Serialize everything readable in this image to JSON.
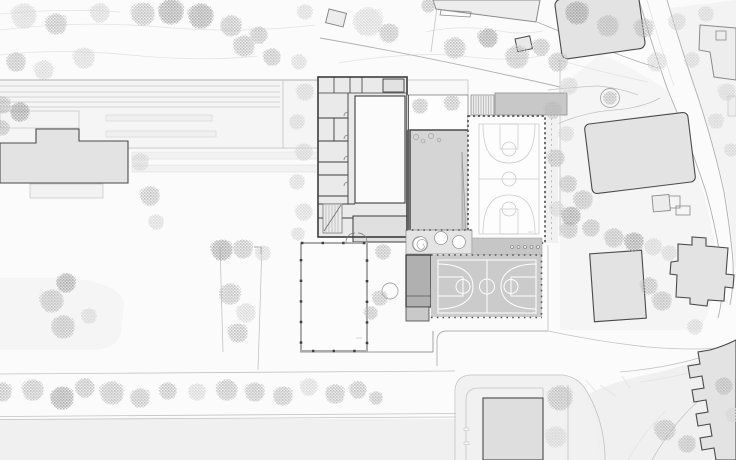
{
  "document": {
    "type": "architectural-site-plan",
    "visible_text": [],
    "note": "black-and-white site plan of a school complex; the only text in the drawing is a few sub-pixel illegible elevation/room labels"
  },
  "palette": {
    "bg": "#fbfbfb",
    "parcel": "#f5f5f5",
    "parcel2": "#f0f0f0",
    "track": "#c6c6c6",
    "contour": "#e3e3e3",
    "roadline": "#c3c3c3",
    "roadline2": "#b0b0b0",
    "bld_fill": "#e3e3e3",
    "bld_fill_light": "#ededed",
    "bld_stroke": "#8a8a8a",
    "bld_stroke_dark": "#4a4a4a",
    "floor": "#eaeaea",
    "wall": "#3c3c3c",
    "wall_mid": "#777777",
    "room_white": "#fbfbfb",
    "gym": "#d5d5d5",
    "roof": "#c8c8c8",
    "dark_annex": "#b0b0b0",
    "court_out": "#cbcbcb",
    "court_out_sub": "#c6c6c6",
    "court_line_in": "#c9c9c9",
    "fence": "#555555",
    "tree_l": "#d2d2d2",
    "tree_m": "#b7b7b7",
    "tree_d": "#9d9d9d",
    "white": "#ffffff"
  },
  "features": [
    {
      "name": "school-main-building",
      "kind": "detailed floor plan with classrooms, corridor, stair"
    },
    {
      "name": "gymnasium",
      "kind": "grey hall with ramp and equipment circles"
    },
    {
      "name": "indoor-basketball-court",
      "kind": "vertical court inside glazed hall, dashed facade"
    },
    {
      "name": "outdoor-basketball-court",
      "kind": "horizontal grey court with white markings and fence posts"
    },
    {
      "name": "pavilion-annex",
      "kind": "white post-and-beam hall south-west of the school"
    },
    {
      "name": "dark-storage-annex",
      "kind": "dark grey service building beside outdoor court"
    },
    {
      "name": "courtyard-with-trees",
      "kind": "open patio north of gymnasium"
    },
    {
      "name": "spiral-stair-circle",
      "kind": "spiral element in band of three circles"
    },
    {
      "name": "railway-tracks-and-platforms",
      "kind": "parallel tracks band, upper left"
    },
    {
      "name": "context-buildings",
      "kind": "surrounding residential/institutional blocks in light grey"
    },
    {
      "name": "diagonal-road",
      "kind": "street running down the right side"
    },
    {
      "name": "street-with-tree-row",
      "kind": "avenue along the bottom edge"
    },
    {
      "name": "topography-contours",
      "kind": "faint contour lines across the top"
    }
  ],
  "trees": [
    [
      24,
      16,
      13,
      "l"
    ],
    [
      56,
      24,
      11,
      "m"
    ],
    [
      100,
      13,
      10,
      "l"
    ],
    [
      143,
      14,
      12,
      "m"
    ],
    [
      171,
      12,
      13,
      "d"
    ],
    [
      201,
      16,
      13,
      "d"
    ],
    [
      231,
      26,
      11,
      "m"
    ],
    [
      259,
      35,
      9,
      "m"
    ],
    [
      305,
      12,
      8,
      "l"
    ],
    [
      368,
      22,
      15,
      "l"
    ],
    [
      389,
      33,
      10,
      "m"
    ],
    [
      428,
      6,
      7,
      "m"
    ],
    [
      455,
      48,
      11,
      "m"
    ],
    [
      488,
      38,
      10,
      "d"
    ],
    [
      517,
      57,
      12,
      "m"
    ],
    [
      541,
      47,
      9,
      "m"
    ],
    [
      577,
      13,
      12,
      "d"
    ],
    [
      608,
      26,
      11,
      "m"
    ],
    [
      644,
      28,
      10,
      "m"
    ],
    [
      677,
      22,
      9,
      "l"
    ],
    [
      706,
      14,
      8,
      "l"
    ],
    [
      657,
      62,
      10,
      "l"
    ],
    [
      692,
      60,
      8,
      "l"
    ],
    [
      727,
      92,
      9,
      "l"
    ],
    [
      716,
      121,
      8,
      "l"
    ],
    [
      731,
      150,
      7,
      "l"
    ],
    [
      16,
      62,
      10,
      "m"
    ],
    [
      44,
      70,
      10,
      "l"
    ],
    [
      84,
      58,
      11,
      "l"
    ],
    [
      244,
      46,
      11,
      "m"
    ],
    [
      272,
      57,
      9,
      "m"
    ],
    [
      2,
      105,
      9,
      "m"
    ],
    [
      20,
      112,
      10,
      "d"
    ],
    [
      2,
      128,
      8,
      "m"
    ],
    [
      140,
      162,
      9,
      "l"
    ],
    [
      150,
      196,
      10,
      "m"
    ],
    [
      156,
      222,
      8,
      "l"
    ],
    [
      299,
      62,
      8,
      "l"
    ],
    [
      305,
      92,
      9,
      "l"
    ],
    [
      297,
      122,
      8,
      "l"
    ],
    [
      304,
      152,
      9,
      "l"
    ],
    [
      297,
      182,
      8,
      "l"
    ],
    [
      304,
      212,
      9,
      "l"
    ],
    [
      298,
      234,
      7,
      "l"
    ],
    [
      420,
      106,
      8,
      "m"
    ],
    [
      452,
      103,
      8,
      "m"
    ],
    [
      383,
      252,
      8,
      "m"
    ],
    [
      380,
      298,
      8,
      "m"
    ],
    [
      371,
      313,
      7,
      "m"
    ],
    [
      66,
      283,
      10,
      "d"
    ],
    [
      52,
      301,
      12,
      "m"
    ],
    [
      63,
      327,
      12,
      "m"
    ],
    [
      89,
      316,
      8,
      "l"
    ],
    [
      222,
      250,
      11,
      "d"
    ],
    [
      243,
      249,
      10,
      "m"
    ],
    [
      263,
      253,
      8,
      "l"
    ],
    [
      230,
      294,
      11,
      "m"
    ],
    [
      246,
      313,
      10,
      "l"
    ],
    [
      238,
      333,
      10,
      "m"
    ],
    [
      2,
      392,
      10,
      "m"
    ],
    [
      33,
      390,
      11,
      "m"
    ],
    [
      62,
      398,
      12,
      "d"
    ],
    [
      85,
      388,
      10,
      "m"
    ],
    [
      112,
      393,
      12,
      "m"
    ],
    [
      140,
      398,
      10,
      "m"
    ],
    [
      168,
      391,
      9,
      "m"
    ],
    [
      197,
      392,
      9,
      "l"
    ],
    [
      227,
      390,
      11,
      "m"
    ],
    [
      255,
      392,
      10,
      "m"
    ],
    [
      283,
      396,
      10,
      "m"
    ],
    [
      309,
      387,
      9,
      "l"
    ],
    [
      335,
      394,
      10,
      "m"
    ],
    [
      358,
      390,
      9,
      "m"
    ],
    [
      376,
      398,
      7,
      "m"
    ],
    [
      560,
      398,
      13,
      "m"
    ],
    [
      556,
      437,
      11,
      "l"
    ],
    [
      558,
      62,
      10,
      "m"
    ],
    [
      569,
      86,
      9,
      "l"
    ],
    [
      553,
      110,
      9,
      "m"
    ],
    [
      566,
      134,
      8,
      "l"
    ],
    [
      556,
      158,
      9,
      "m"
    ],
    [
      568,
      184,
      9,
      "m"
    ],
    [
      557,
      209,
      8,
      "l"
    ],
    [
      569,
      230,
      9,
      "m"
    ],
    [
      583,
      200,
      10,
      "m"
    ],
    [
      571,
      216,
      10,
      "d"
    ],
    [
      591,
      228,
      9,
      "m"
    ],
    [
      614,
      238,
      10,
      "m"
    ],
    [
      634,
      242,
      10,
      "d"
    ],
    [
      653,
      247,
      9,
      "l"
    ],
    [
      669,
      253,
      8,
      "l"
    ],
    [
      610,
      98,
      7,
      "m"
    ],
    [
      649,
      286,
      9,
      "m"
    ],
    [
      662,
      301,
      10,
      "m"
    ],
    [
      695,
      327,
      8,
      "l"
    ],
    [
      665,
      430,
      11,
      "m"
    ],
    [
      687,
      444,
      9,
      "m"
    ],
    [
      724,
      386,
      9,
      "m"
    ],
    [
      734,
      415,
      8,
      "l"
    ]
  ]
}
